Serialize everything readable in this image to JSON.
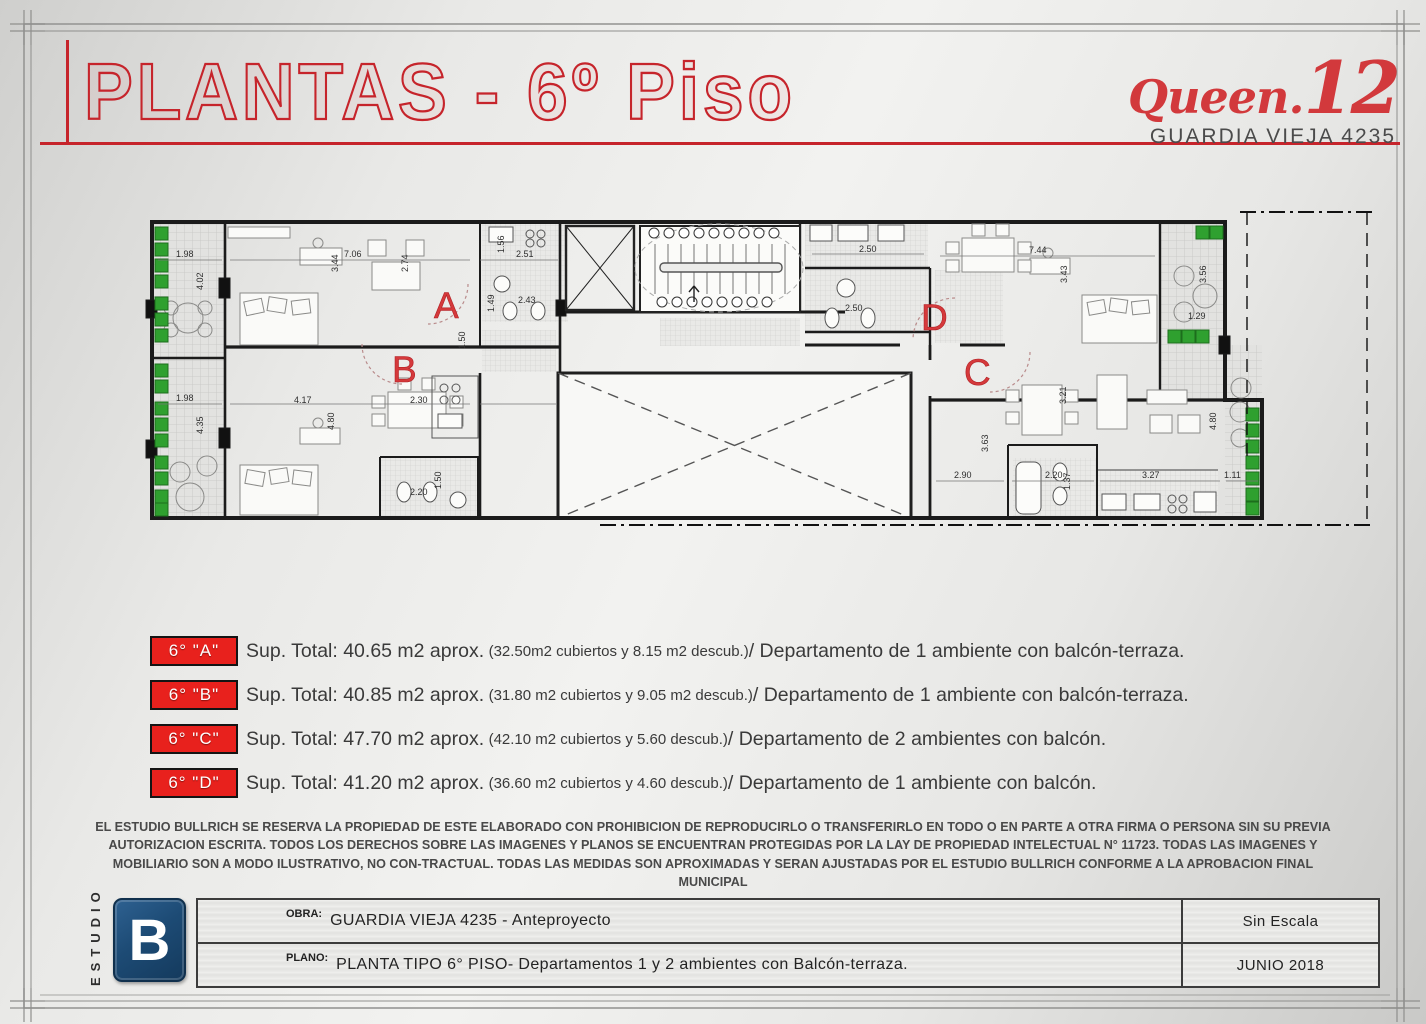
{
  "header": {
    "title": "PLANTAS - 6º Piso",
    "logo": {
      "brand": "Queen.",
      "number": "12",
      "address": "GUARDIA VIEJA 4235"
    }
  },
  "plan": {
    "units": [
      "A",
      "B",
      "C",
      "D"
    ],
    "dimensions": [
      "1.98",
      "4.02",
      "7.06",
      "3.44",
      "2.74",
      "1.56",
      "2.51",
      "2.43",
      "1.49",
      "1.50",
      "1.98",
      "4.35",
      "4.17",
      "2.30",
      "4.80",
      "2.20",
      "1.50",
      "2.50",
      "2.50",
      "7.44",
      "3.43",
      "3.56",
      "1.29",
      "3.21",
      "3.63",
      "2.90",
      "2.20",
      "1.37",
      "3.27",
      "1.11",
      "4.80"
    ]
  },
  "legend": {
    "items": [
      {
        "tag": "6° \"A\"",
        "sup": "Sup. Total: 40.65 m2 aprox.",
        "sub": "(32.50m2 cubiertos y 8.15 m2 descub.)",
        "desc": " / Departamento de 1 ambiente con balcón-terraza."
      },
      {
        "tag": "6° \"B\"",
        "sup": "Sup. Total: 40.85 m2 aprox.",
        "sub": "(31.80 m2 cubiertos y 9.05 m2 descub.)",
        "desc": " / Departamento de 1 ambiente con balcón-terraza."
      },
      {
        "tag": "6° \"C\"",
        "sup": "Sup. Total: 47.70 m2 aprox.",
        "sub": "(42.10 m2 cubiertos y 5.60 descub.)",
        "desc": "/ Departamento de 2 ambientes con balcón."
      },
      {
        "tag": "6° \"D\"",
        "sup": "Sup. Total: 41.20 m2 aprox.",
        "sub": "(36.60 m2 cubiertos y 4.60 descub.)",
        "desc": "/ Departamento de 1 ambiente con balcón."
      }
    ]
  },
  "disclaimer": "EL ESTUDIO BULLRICH SE RESERVA LA PROPIEDAD DE ESTE ELABORADO CON PROHIBICION DE REPRODUCIRLO O TRANSFERIRLO EN TODO O EN PARTE A OTRA FIRMA O PERSONA SIN SU PREVIA AUTORIZACION ESCRITA. TODOS LOS DERECHOS SOBRE LAS IMAGENES Y PLANOS SE ENCUENTRAN PROTEGIDAS POR LA LAY DE PROPIEDAD INTELECTUAL N° 11723.  TODAS LAS IMAGENES Y MOBILIARIO SON A MODO ILUSTRATIVO, NO CON-TRACTUAL. TODAS LAS MEDIDAS SON APROXIMADAS Y SERAN AJUSTADAS POR EL ESTUDIO BULLRICH CONFORME A LA APROBACION FINAL MUNICIPAL",
  "titleblock": {
    "studio_vertical": "ESTUDIO",
    "logo_letter": "B",
    "obra_label": "OBRA:",
    "obra_value": "GUARDIA VIEJA 4235 - Anteproyecto",
    "plano_label": "PLANO:",
    "plano_value": "PLANTA TIPO 6° PISO- Departamentos  1 y 2 ambientes con Balcón-terraza.",
    "scale": "Sin Escala",
    "date": "JUNIO 2018"
  },
  "colors": {
    "accent_red": "#c6242b",
    "legend_red": "#e8211d",
    "plan_green": "#2fa02f",
    "footer_blue": "#1d4b75"
  }
}
